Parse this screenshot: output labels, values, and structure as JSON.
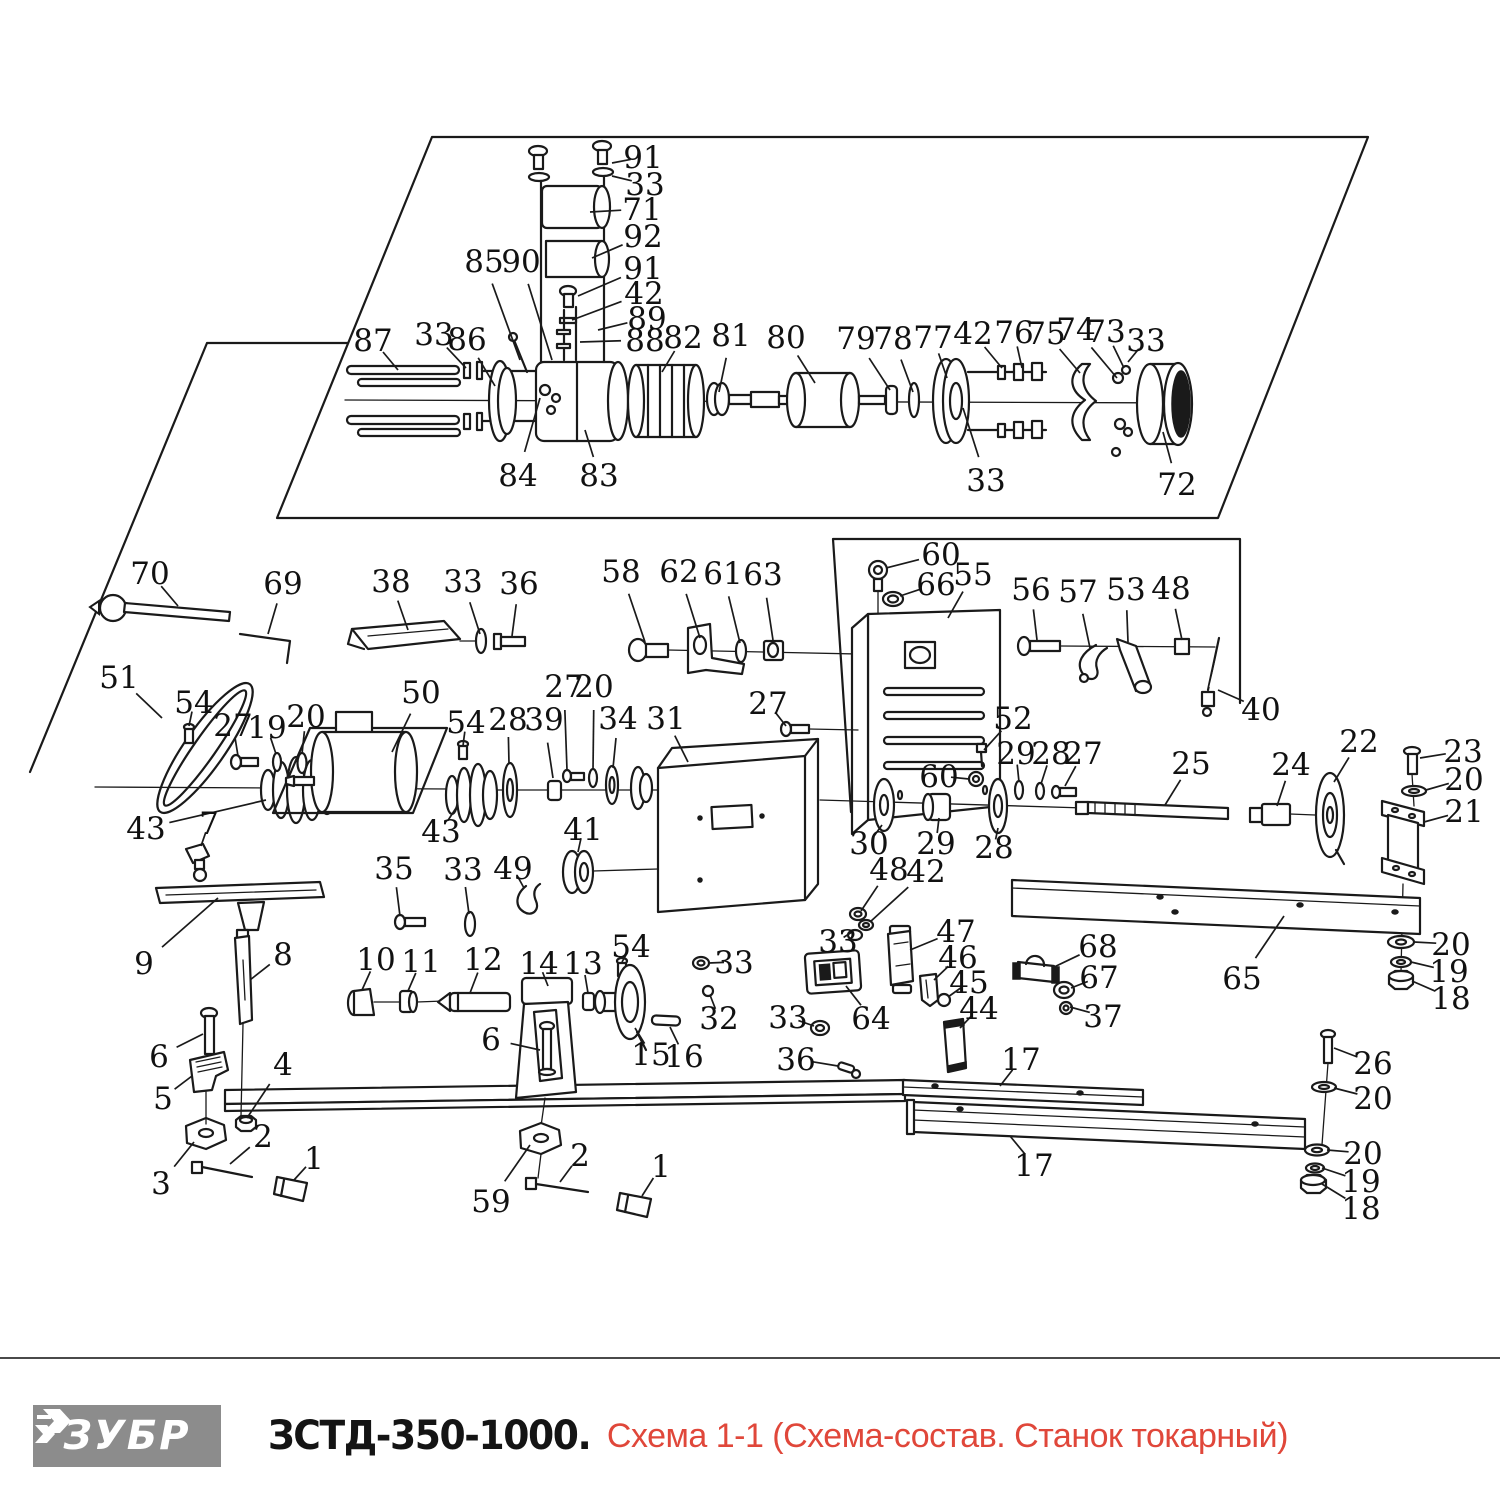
{
  "footer": {
    "brand": "ЗУБР",
    "model": "ЗСТД-350-1000.",
    "subtitle": " Схема 1-1 (Схема-состав. Станок токарный)",
    "colors": {
      "logo_bg": "#8c8c8c",
      "logo_text": "#ffffff",
      "model_text": "#141414",
      "subtitle_text": "#e0473a",
      "line_color": "#1a1a1a"
    }
  },
  "diagram": {
    "callouts": [
      {
        "n": "91",
        "x": 643,
        "y": 157,
        "tx": 612,
        "ty": 163
      },
      {
        "n": "33",
        "x": 645,
        "y": 184,
        "tx": 612,
        "ty": 176
      },
      {
        "n": "71",
        "x": 642,
        "y": 209,
        "tx": 590,
        "ty": 212
      },
      {
        "n": "92",
        "x": 643,
        "y": 236,
        "tx": 592,
        "ty": 258
      },
      {
        "n": "85",
        "x": 484,
        "y": 261,
        "tx": 520,
        "ty": 360
      },
      {
        "n": "90",
        "x": 521,
        "y": 261,
        "tx": 552,
        "ty": 360
      },
      {
        "n": "91",
        "x": 643,
        "y": 268,
        "tx": 578,
        "ty": 296
      },
      {
        "n": "42",
        "x": 644,
        "y": 293,
        "tx": 572,
        "ty": 320
      },
      {
        "n": "89",
        "x": 647,
        "y": 318,
        "tx": 598,
        "ty": 330
      },
      {
        "n": "88",
        "x": 645,
        "y": 340,
        "tx": 580,
        "ty": 342
      },
      {
        "n": "82",
        "x": 683,
        "y": 337,
        "tx": 662,
        "ty": 372
      },
      {
        "n": "81",
        "x": 731,
        "y": 335,
        "tx": 719,
        "ty": 392
      },
      {
        "n": "80",
        "x": 786,
        "y": 337,
        "tx": 815,
        "ty": 383
      },
      {
        "n": "79",
        "x": 856,
        "y": 338,
        "tx": 890,
        "ty": 390
      },
      {
        "n": "78",
        "x": 893,
        "y": 338,
        "tx": 913,
        "ty": 392
      },
      {
        "n": "77",
        "x": 933,
        "y": 337,
        "tx": 947,
        "ty": 378
      },
      {
        "n": "42",
        "x": 973,
        "y": 333,
        "tx": 1002,
        "ty": 368
      },
      {
        "n": "76",
        "x": 1014,
        "y": 332,
        "tx": 1022,
        "ty": 368
      },
      {
        "n": "75",
        "x": 1046,
        "y": 333,
        "tx": 1080,
        "ty": 373
      },
      {
        "n": "74",
        "x": 1076,
        "y": 329,
        "tx": 1117,
        "ty": 378
      },
      {
        "n": "73",
        "x": 1106,
        "y": 331,
        "tx": 1124,
        "ty": 368
      },
      {
        "n": "33",
        "x": 1146,
        "y": 340,
        "tx": 1128,
        "ty": 362
      },
      {
        "n": "87",
        "x": 373,
        "y": 340,
        "tx": 398,
        "ty": 370
      },
      {
        "n": "33",
        "x": 434,
        "y": 334,
        "tx": 466,
        "ty": 368
      },
      {
        "n": "86",
        "x": 467,
        "y": 339,
        "tx": 495,
        "ty": 386
      },
      {
        "n": "84",
        "x": 518,
        "y": 475,
        "tx": 540,
        "ty": 398
      },
      {
        "n": "83",
        "x": 599,
        "y": 475,
        "tx": 585,
        "ty": 430
      },
      {
        "n": "33",
        "x": 986,
        "y": 480,
        "tx": 963,
        "ty": 408
      },
      {
        "n": "72",
        "x": 1177,
        "y": 484,
        "tx": 1163,
        "ty": 432
      },
      {
        "n": "70",
        "x": 150,
        "y": 573,
        "tx": 178,
        "ty": 606
      },
      {
        "n": "69",
        "x": 283,
        "y": 583,
        "tx": 268,
        "ty": 634
      },
      {
        "n": "38",
        "x": 391,
        "y": 581,
        "tx": 408,
        "ty": 630
      },
      {
        "n": "33",
        "x": 463,
        "y": 581,
        "tx": 480,
        "ty": 634
      },
      {
        "n": "36",
        "x": 519,
        "y": 583,
        "tx": 512,
        "ty": 636
      },
      {
        "n": "58",
        "x": 621,
        "y": 571,
        "tx": 645,
        "ty": 642
      },
      {
        "n": "62",
        "x": 679,
        "y": 571,
        "tx": 700,
        "ty": 638
      },
      {
        "n": "61",
        "x": 723,
        "y": 573,
        "tx": 740,
        "ty": 643
      },
      {
        "n": "63",
        "x": 763,
        "y": 574,
        "tx": 773,
        "ty": 640
      },
      {
        "n": "60",
        "x": 941,
        "y": 554,
        "tx": 886,
        "ty": 568
      },
      {
        "n": "66",
        "x": 936,
        "y": 584,
        "tx": 900,
        "ty": 596
      },
      {
        "n": "55",
        "x": 973,
        "y": 574,
        "tx": 948,
        "ty": 618
      },
      {
        "n": "56",
        "x": 1031,
        "y": 589,
        "tx": 1037,
        "ty": 640
      },
      {
        "n": "57",
        "x": 1078,
        "y": 591,
        "tx": 1090,
        "ty": 648
      },
      {
        "n": "53",
        "x": 1126,
        "y": 589,
        "tx": 1128,
        "ty": 642
      },
      {
        "n": "48",
        "x": 1171,
        "y": 588,
        "tx": 1182,
        "ty": 640
      },
      {
        "n": "40",
        "x": 1261,
        "y": 709,
        "tx": 1218,
        "ty": 690
      },
      {
        "n": "51",
        "x": 119,
        "y": 677,
        "tx": 162,
        "ty": 718
      },
      {
        "n": "54",
        "x": 194,
        "y": 702,
        "tx": 189,
        "ty": 726
      },
      {
        "n": "27",
        "x": 233,
        "y": 725,
        "tx": 238,
        "ty": 756
      },
      {
        "n": "19",
        "x": 267,
        "y": 727,
        "tx": 276,
        "ty": 754
      },
      {
        "n": "20",
        "x": 306,
        "y": 716,
        "tx": 302,
        "ty": 754
      },
      {
        "n": "50",
        "x": 421,
        "y": 692,
        "tx": 392,
        "ty": 752
      },
      {
        "n": "54",
        "x": 466,
        "y": 722,
        "tx": 463,
        "ty": 746
      },
      {
        "n": "28",
        "x": 508,
        "y": 719,
        "tx": 509,
        "ty": 764
      },
      {
        "n": "39",
        "x": 544,
        "y": 719,
        "tx": 553,
        "ty": 778
      },
      {
        "n": "27",
        "x": 564,
        "y": 686,
        "tx": 567,
        "ty": 770
      },
      {
        "n": "20",
        "x": 594,
        "y": 686,
        "tx": 593,
        "ty": 770
      },
      {
        "n": "34",
        "x": 618,
        "y": 718,
        "tx": 613,
        "ty": 768
      },
      {
        "n": "31",
        "x": 666,
        "y": 718,
        "tx": 688,
        "ty": 762
      },
      {
        "n": "43",
        "x": 146,
        "y": 828,
        "tx": 266,
        "ty": 800
      },
      {
        "n": "7",
        "x": 209,
        "y": 823,
        "tx": 201,
        "ty": 846
      },
      {
        "n": "43",
        "x": 441,
        "y": 831,
        "tx": 458,
        "ty": 805
      },
      {
        "n": "41",
        "x": 583,
        "y": 829,
        "tx": 578,
        "ty": 852
      },
      {
        "n": "27",
        "x": 768,
        "y": 703,
        "tx": 786,
        "ty": 726
      },
      {
        "n": "35",
        "x": 394,
        "y": 868,
        "tx": 400,
        "ty": 916
      },
      {
        "n": "33",
        "x": 463,
        "y": 869,
        "tx": 469,
        "ty": 914
      },
      {
        "n": "49",
        "x": 513,
        "y": 868,
        "tx": 524,
        "ty": 888
      },
      {
        "n": "52",
        "x": 1013,
        "y": 718,
        "tx": 984,
        "ty": 750
      },
      {
        "n": "29",
        "x": 1016,
        "y": 753,
        "tx": 1019,
        "ty": 782
      },
      {
        "n": "28",
        "x": 1051,
        "y": 753,
        "tx": 1041,
        "ty": 784
      },
      {
        "n": "27",
        "x": 1083,
        "y": 753,
        "tx": 1065,
        "ty": 786
      },
      {
        "n": "60",
        "x": 939,
        "y": 776,
        "tx": 969,
        "ty": 779
      },
      {
        "n": "25",
        "x": 1191,
        "y": 763,
        "tx": 1165,
        "ty": 805
      },
      {
        "n": "30",
        "x": 869,
        "y": 843,
        "tx": 882,
        "ty": 825
      },
      {
        "n": "29",
        "x": 936,
        "y": 843,
        "tx": 939,
        "ty": 818
      },
      {
        "n": "28",
        "x": 994,
        "y": 847,
        "tx": 998,
        "ty": 828
      },
      {
        "n": "48",
        "x": 889,
        "y": 869,
        "tx": 861,
        "ty": 911
      },
      {
        "n": "42",
        "x": 926,
        "y": 871,
        "tx": 870,
        "ty": 922
      },
      {
        "n": "24",
        "x": 1291,
        "y": 764,
        "tx": 1277,
        "ty": 806
      },
      {
        "n": "22",
        "x": 1359,
        "y": 741,
        "tx": 1334,
        "ty": 782
      },
      {
        "n": "23",
        "x": 1463,
        "y": 751,
        "tx": 1420,
        "ty": 758
      },
      {
        "n": "20",
        "x": 1464,
        "y": 779,
        "tx": 1426,
        "ty": 790
      },
      {
        "n": "21",
        "x": 1464,
        "y": 811,
        "tx": 1424,
        "ty": 822
      },
      {
        "n": "65",
        "x": 1242,
        "y": 978,
        "tx": 1284,
        "ty": 916
      },
      {
        "n": "20",
        "x": 1451,
        "y": 944,
        "tx": 1414,
        "ty": 942
      },
      {
        "n": "19",
        "x": 1449,
        "y": 971,
        "tx": 1411,
        "ty": 962
      },
      {
        "n": "18",
        "x": 1451,
        "y": 998,
        "tx": 1412,
        "ty": 981
      },
      {
        "n": "9",
        "x": 144,
        "y": 963,
        "tx": 218,
        "ty": 898
      },
      {
        "n": "8",
        "x": 283,
        "y": 954,
        "tx": 250,
        "ty": 980
      },
      {
        "n": "10",
        "x": 376,
        "y": 959,
        "tx": 362,
        "ty": 990
      },
      {
        "n": "11",
        "x": 421,
        "y": 961,
        "tx": 408,
        "ty": 991
      },
      {
        "n": "12",
        "x": 483,
        "y": 959,
        "tx": 470,
        "ty": 993
      },
      {
        "n": "14",
        "x": 539,
        "y": 963,
        "tx": 548,
        "ty": 986
      },
      {
        "n": "13",
        "x": 583,
        "y": 963,
        "tx": 588,
        "ty": 993
      },
      {
        "n": "54",
        "x": 631,
        "y": 946,
        "tx": 622,
        "ty": 962
      },
      {
        "n": "33",
        "x": 734,
        "y": 962,
        "tx": 709,
        "ty": 963
      },
      {
        "n": "32",
        "x": 719,
        "y": 1018,
        "tx": 710,
        "ty": 995
      },
      {
        "n": "6",
        "x": 159,
        "y": 1056,
        "tx": 203,
        "ty": 1034
      },
      {
        "n": "5",
        "x": 163,
        "y": 1098,
        "tx": 192,
        "ty": 1076
      },
      {
        "n": "4",
        "x": 283,
        "y": 1064,
        "tx": 247,
        "ty": 1118
      },
      {
        "n": "3",
        "x": 161,
        "y": 1183,
        "tx": 194,
        "ty": 1142
      },
      {
        "n": "2",
        "x": 263,
        "y": 1136,
        "tx": 230,
        "ty": 1164
      },
      {
        "n": "1",
        "x": 314,
        "y": 1158,
        "tx": 294,
        "ty": 1180
      },
      {
        "n": "6",
        "x": 491,
        "y": 1039,
        "tx": 540,
        "ty": 1050
      },
      {
        "n": "15",
        "x": 651,
        "y": 1054,
        "tx": 635,
        "ty": 1028
      },
      {
        "n": "16",
        "x": 684,
        "y": 1056,
        "tx": 670,
        "ty": 1027
      },
      {
        "n": "59",
        "x": 491,
        "y": 1201,
        "tx": 530,
        "ty": 1145
      },
      {
        "n": "2",
        "x": 580,
        "y": 1155,
        "tx": 560,
        "ty": 1182
      },
      {
        "n": "1",
        "x": 661,
        "y": 1166,
        "tx": 642,
        "ty": 1196
      },
      {
        "n": "33",
        "x": 788,
        "y": 1017,
        "tx": 814,
        "ty": 1026
      },
      {
        "n": "36",
        "x": 796,
        "y": 1059,
        "tx": 838,
        "ty": 1066
      },
      {
        "n": "64",
        "x": 871,
        "y": 1018,
        "tx": 846,
        "ty": 986
      },
      {
        "n": "33",
        "x": 838,
        "y": 941,
        "tx": 852,
        "ty": 932
      },
      {
        "n": "47",
        "x": 956,
        "y": 931,
        "tx": 910,
        "ty": 950
      },
      {
        "n": "46",
        "x": 958,
        "y": 957,
        "tx": 934,
        "ty": 980
      },
      {
        "n": "45",
        "x": 969,
        "y": 982,
        "tx": 948,
        "ty": 997
      },
      {
        "n": "44",
        "x": 979,
        "y": 1008,
        "tx": 960,
        "ty": 1028
      },
      {
        "n": "68",
        "x": 1098,
        "y": 946,
        "tx": 1052,
        "ty": 968
      },
      {
        "n": "67",
        "x": 1099,
        "y": 977,
        "tx": 1071,
        "ty": 988
      },
      {
        "n": "37",
        "x": 1103,
        "y": 1016,
        "tx": 1070,
        "ty": 1007
      },
      {
        "n": "17",
        "x": 1021,
        "y": 1059,
        "tx": 1000,
        "ty": 1086
      },
      {
        "n": "17",
        "x": 1034,
        "y": 1165,
        "tx": 1010,
        "ty": 1136
      },
      {
        "n": "26",
        "x": 1373,
        "y": 1063,
        "tx": 1334,
        "ty": 1048
      },
      {
        "n": "20",
        "x": 1373,
        "y": 1098,
        "tx": 1334,
        "ty": 1088
      },
      {
        "n": "20",
        "x": 1363,
        "y": 1153,
        "tx": 1327,
        "ty": 1150
      },
      {
        "n": "19",
        "x": 1361,
        "y": 1181,
        "tx": 1322,
        "ty": 1168
      },
      {
        "n": "18",
        "x": 1361,
        "y": 1208,
        "tx": 1322,
        "ty": 1184
      }
    ]
  }
}
